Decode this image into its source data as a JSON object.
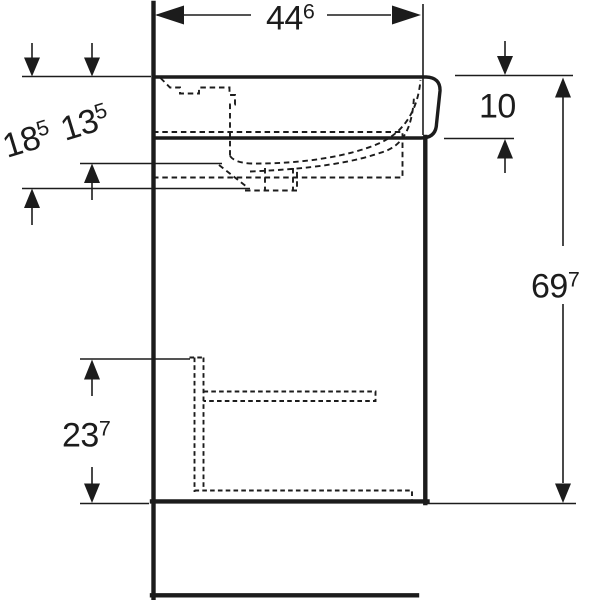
{
  "diagram": {
    "subject": "wall-hung washbasin with vanity cabinet, side section technical drawing",
    "colors": {
      "line": "#1c1c1c",
      "background": "#ffffff"
    },
    "labels": {
      "width": {
        "main": "44",
        "sup": "6"
      },
      "basin_front_height": {
        "main": "10",
        "sup": ""
      },
      "bowl_depth": {
        "main": "13",
        "sup": "5"
      },
      "trap_depth": {
        "main": "18",
        "sup": "5"
      },
      "total_height": {
        "main": "69",
        "sup": "7"
      },
      "lower_clearance": {
        "main": "23",
        "sup": "7"
      }
    }
  }
}
